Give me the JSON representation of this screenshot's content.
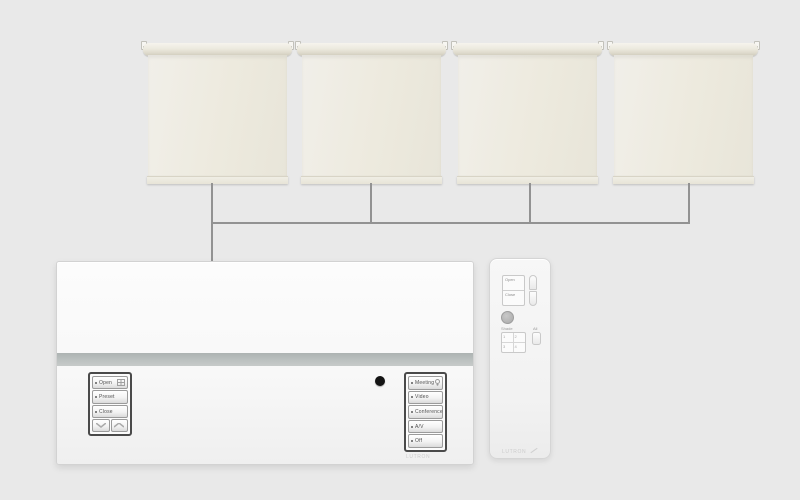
{
  "colors": {
    "background": "#e9e9e9",
    "wire": "#929292",
    "panel_accent_band": "#b7bcbb",
    "shade_fabric": "#edeade",
    "ir_sensor": "#141414"
  },
  "panel": {
    "left_keypad": {
      "buttons": [
        {
          "label": "Open",
          "icon": "window-grid-icon"
        },
        {
          "label": "Preset",
          "icon": ""
        },
        {
          "label": "Close",
          "icon": ""
        }
      ],
      "rocker": {
        "down_icon": "chevron-down-icon",
        "up_icon": "chevron-up-icon"
      }
    },
    "right_keypad": {
      "buttons": [
        {
          "label": "Meeting",
          "icon": "lightbulb-icon"
        },
        {
          "label": "Video",
          "icon": ""
        },
        {
          "label": "Conference",
          "icon": ""
        },
        {
          "label": "A/V",
          "icon": ""
        },
        {
          "label": "Off",
          "icon": ""
        }
      ],
      "brand": "LUTRON"
    }
  },
  "remote": {
    "open_label": "Open",
    "close_label": "Close",
    "shade_label": "Shade",
    "all_label": "All",
    "zone_buttons": [
      "1",
      "2",
      "3",
      "4"
    ],
    "brand": "LUTRON"
  }
}
